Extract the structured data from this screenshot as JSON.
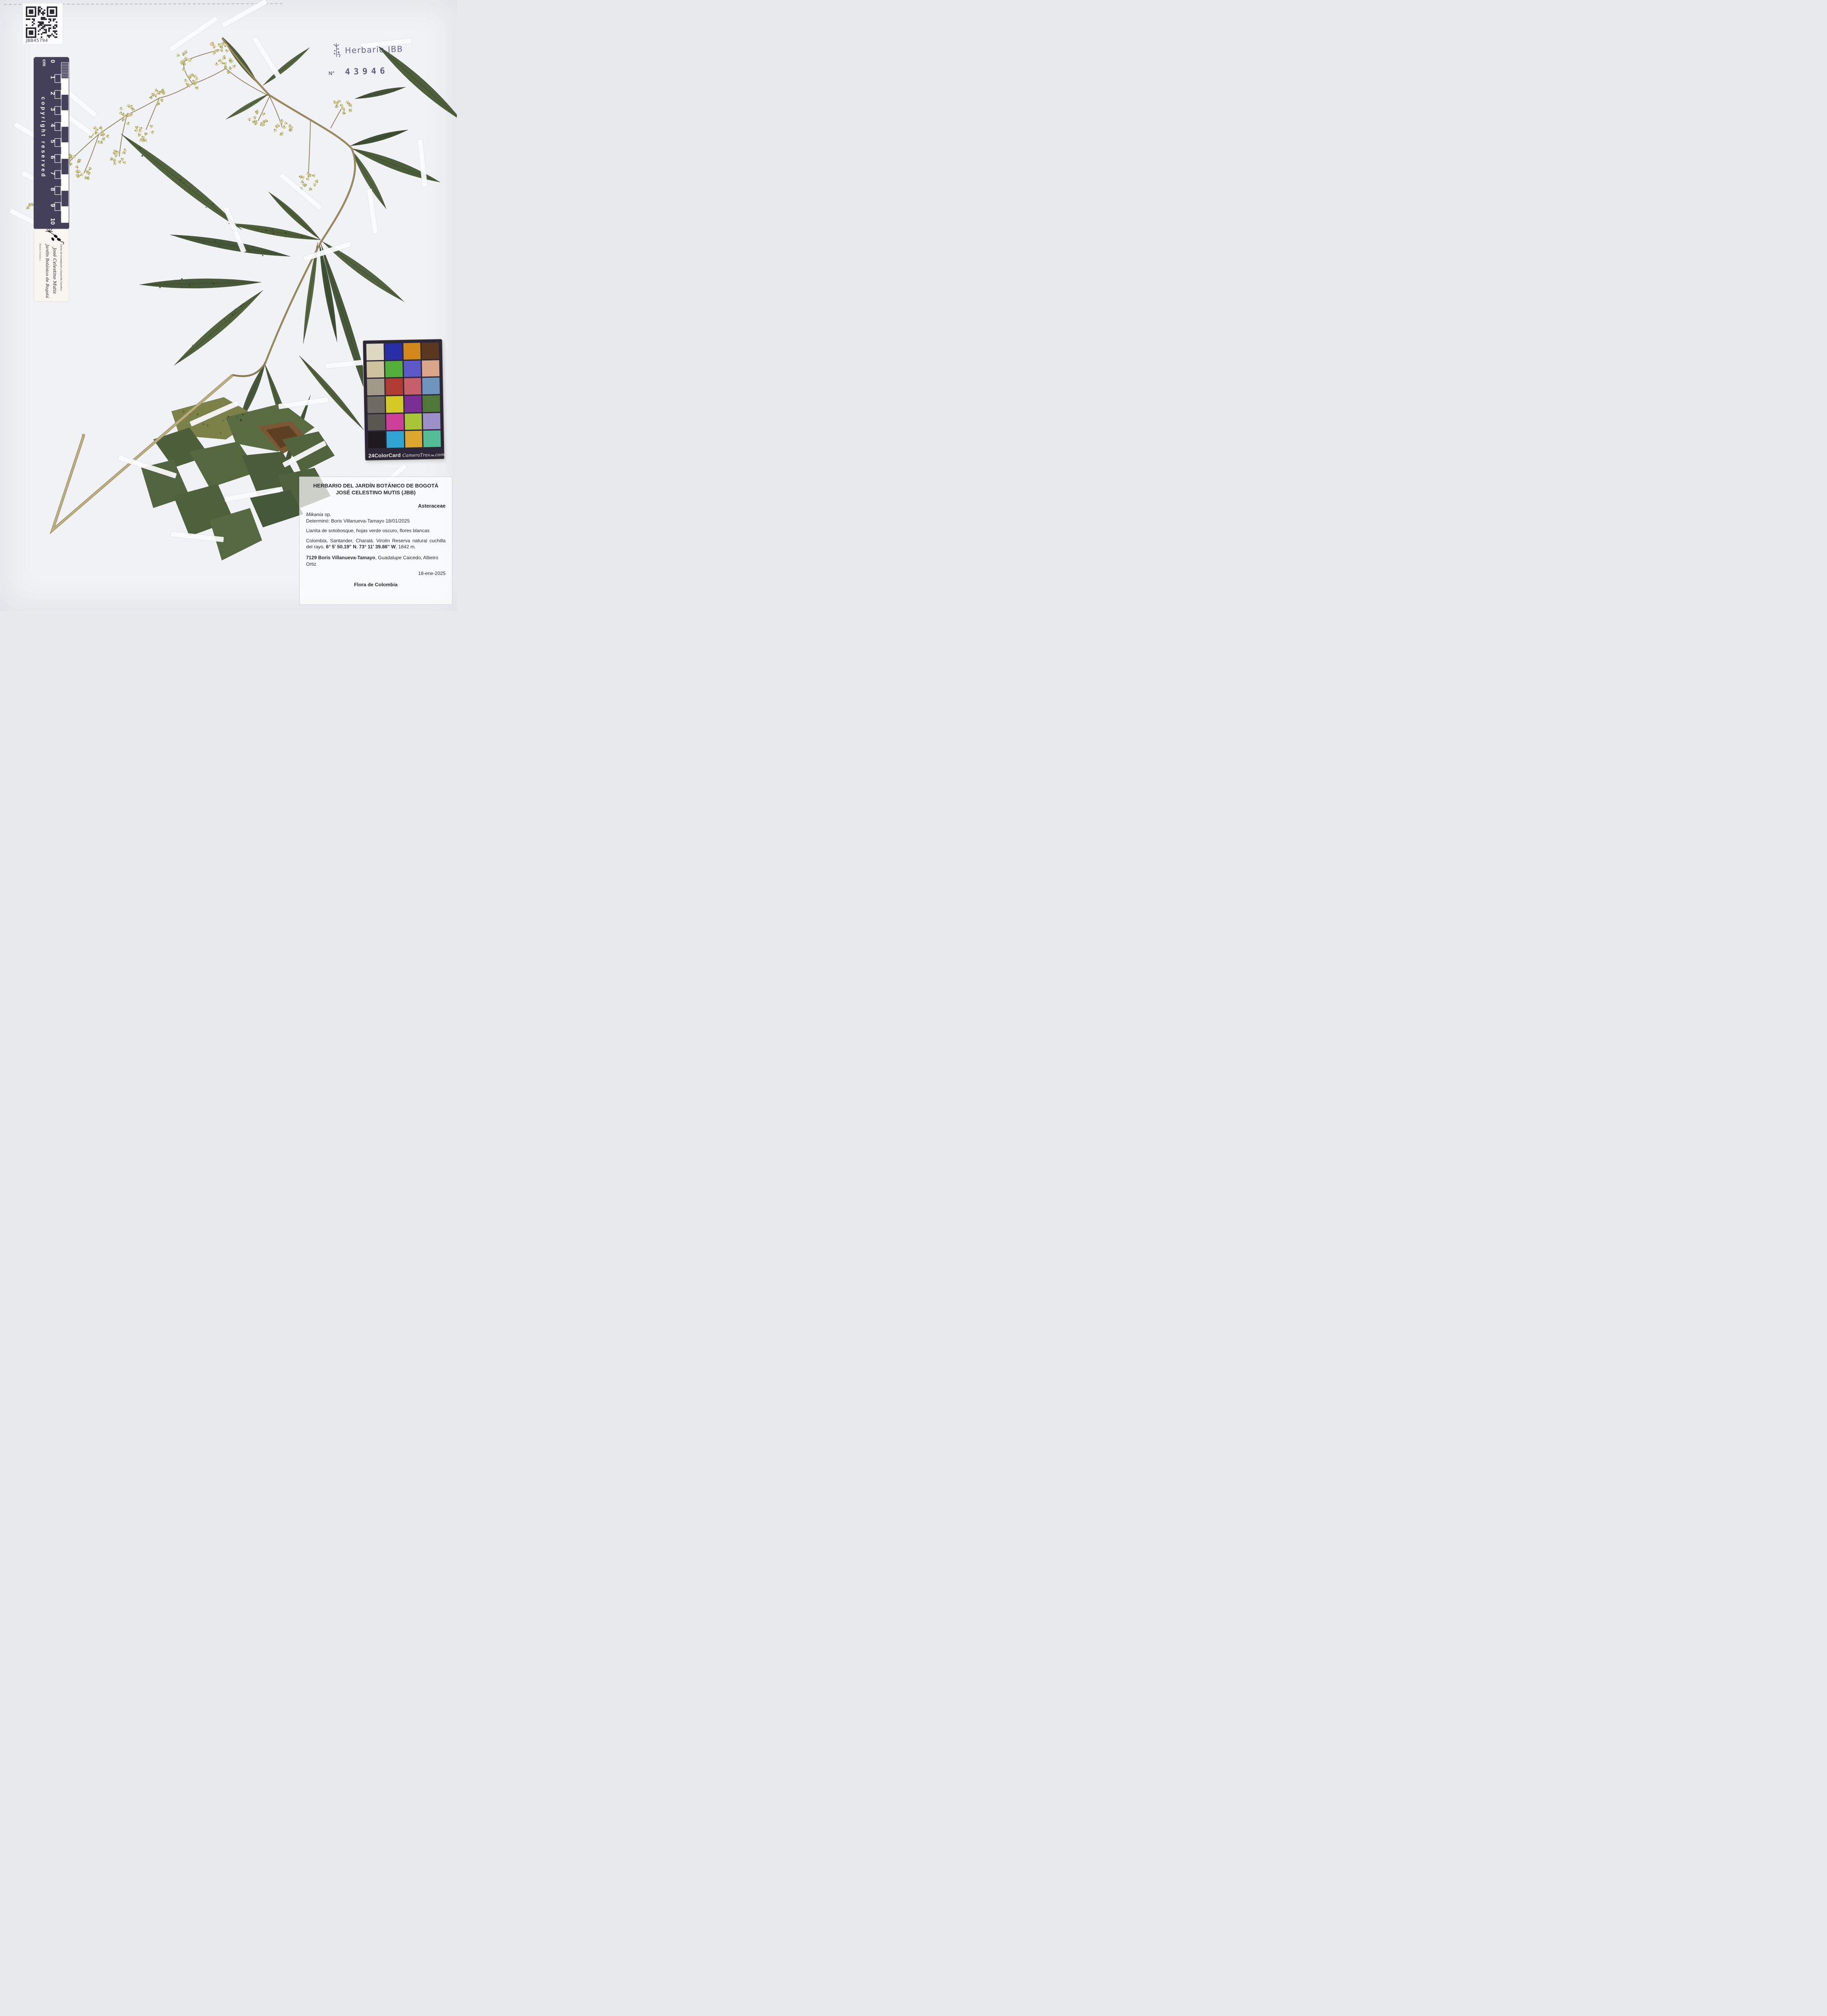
{
  "photo": {
    "background": "#f0f2f5"
  },
  "qr": {
    "label": "JBB45794"
  },
  "stamp": {
    "title": "Herbario JBB",
    "number_label": "N°",
    "number": "43946",
    "ink_color": "#5a5480"
  },
  "ruler": {
    "unit": "cm",
    "ticks": [
      "0",
      "1",
      "2",
      "3",
      "4",
      "5",
      "6",
      "7",
      "8",
      "9",
      "10"
    ],
    "copyright": "copyright reserved",
    "logo": {
      "line1": "Jardín Botánico de Bogotá",
      "line2": "José Celestino Mutis",
      "line3": "Centro de Investigación y Desarrollo Científico",
      "species_note": "Mutisia clematis L."
    }
  },
  "colorcard": {
    "title": "24ColorCard",
    "brand": "CameraTrax",
    "tm": "TM",
    "suffix": ".com",
    "swatches": [
      "#ddd8c2",
      "#2a2ea6",
      "#d3881c",
      "#59381f",
      "#cec29f",
      "#54ae3c",
      "#5b5ac8",
      "#d9a488",
      "#a19a88",
      "#b03b33",
      "#c75f6b",
      "#6f94bd",
      "#6f6b63",
      "#d3ca25",
      "#7b2f96",
      "#4f7838",
      "#585751",
      "#cd3f98",
      "#a8c437",
      "#9d8fc7",
      "#1d1b1d",
      "#30a5d4",
      "#dca62f",
      "#52bd97"
    ]
  },
  "label": {
    "header1": "HERBARIO DEL JARDÍN BOTÁNICO DE BOGOTÁ",
    "header2": "JOSÉ CELESTINO MUTIS (JBB)",
    "family": "Asteraceae",
    "taxon_genus": "Mikania",
    "taxon_rest": " sp.",
    "determination": "Determinó: Boris Villanueva-Tamayo 18/01/2025",
    "description": "Lianita de sotobosque, hojas verde oscuro, flores blancas",
    "locality_pre": "Colombia, Santander, Charalá. Virolín Reserva natural cuchilla del rayo, ",
    "coord_n": "6° 5' 50.19\" N",
    "locality_mid": ", ",
    "coord_w": "73° 11' 39.86\" W",
    "locality_post": ", 1842 m.",
    "collectors_bold": "7129 Boris Villanueva-Tamayo",
    "collectors_rest": ", Guadalupe Caicedo, Albeiro Ortiz",
    "date": "18-ene-2025",
    "footer": "Flora de Colombia"
  },
  "specimen": {
    "palette": {
      "leaf_green": "#51633d",
      "leaf_dark": "#43543a",
      "stem_khaki": "#b2a577",
      "flower_cream": "#d9d3aa"
    }
  }
}
